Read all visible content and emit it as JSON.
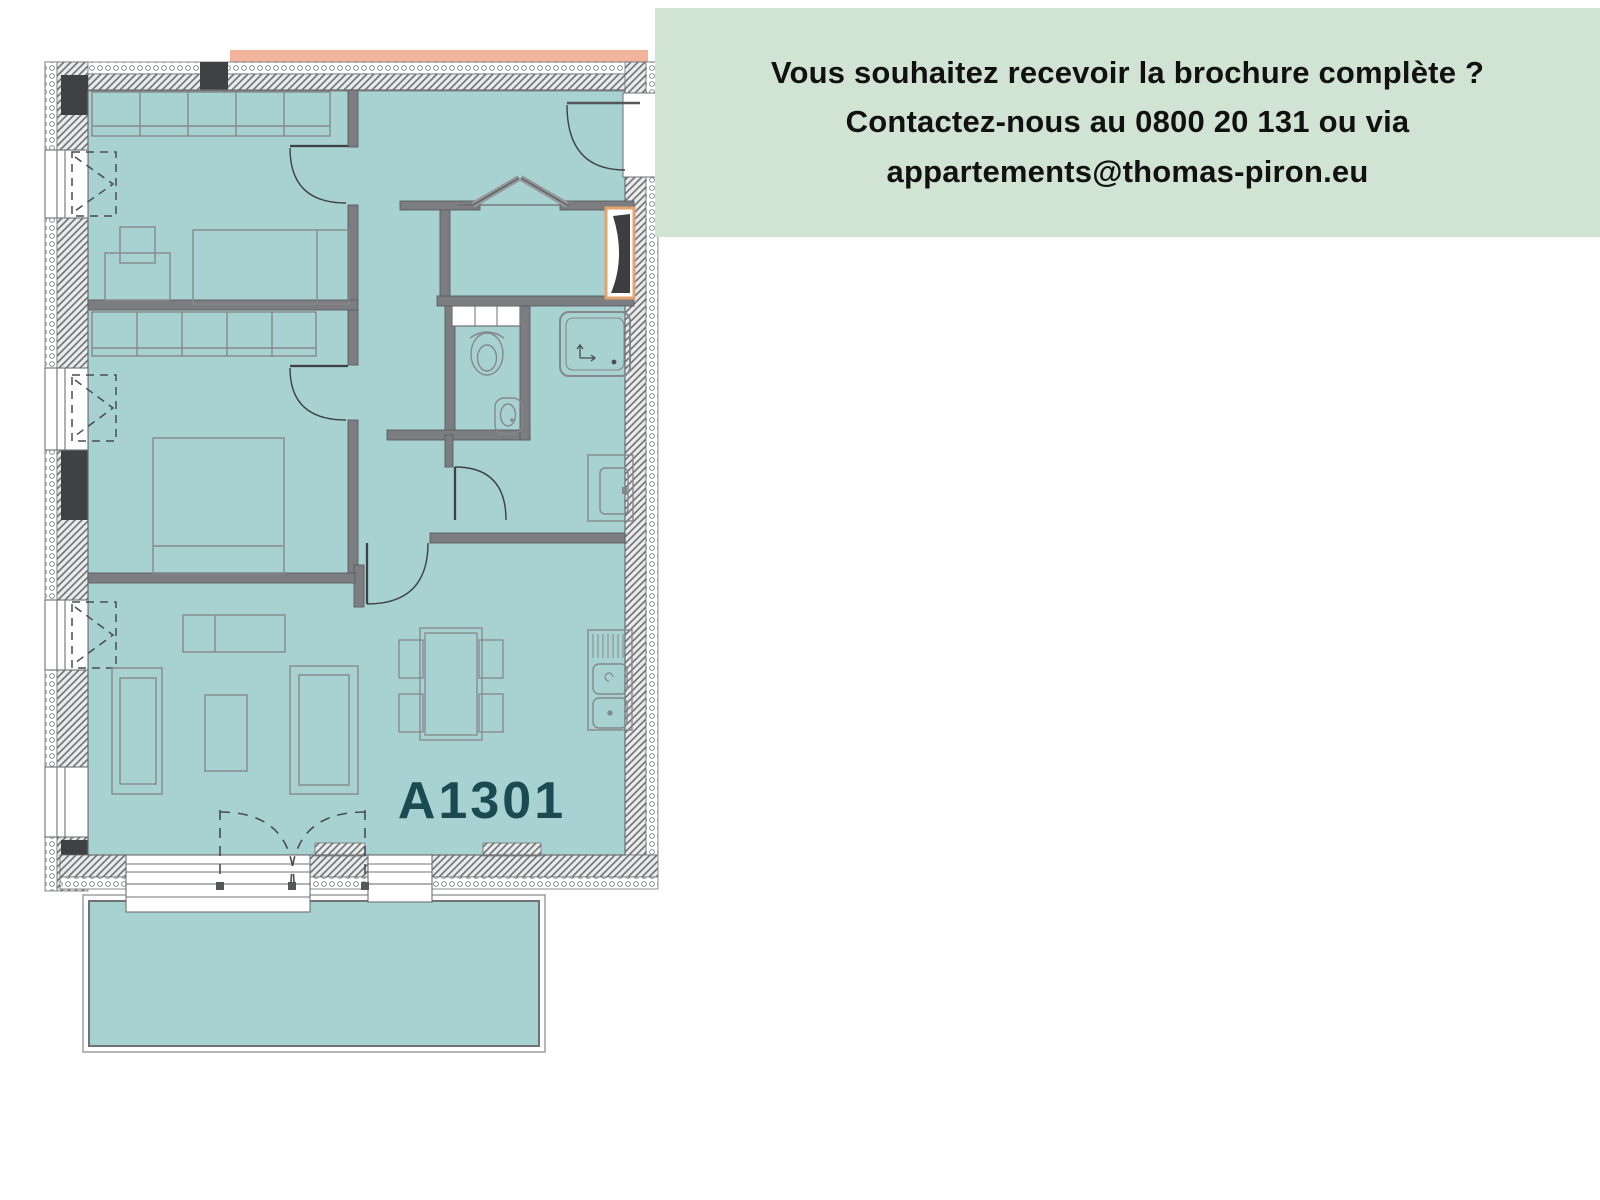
{
  "info_box": {
    "line1": "Vous souhaitez recevoir la brochure complète ?",
    "line2": "Contactez-nous au 0800 20 131 ou via",
    "line3": "appartements@thomas-piron.eu",
    "background_color": "#d1e3d3",
    "text_color": "#111111"
  },
  "floor_plan": {
    "unit_label": "A1301",
    "unit_label_color": "#1a4a52",
    "floor_fill_color": "#a8d1d2",
    "balcony_fill_color": "#a8d1d2",
    "interior_wall_color": "#7b7d80",
    "exterior_top_strip_color": "#f2b49d",
    "shaft_accent_color": "#e2a36e",
    "fixture_icons": [
      "wardrobe",
      "bed",
      "desk",
      "chair",
      "sofa",
      "coffee-table",
      "sideboard",
      "dining-table",
      "kitchen-sink",
      "cooktop",
      "shower",
      "washing-machine",
      "toilet",
      "hand-basin",
      "balcony",
      "window",
      "door-swing"
    ]
  }
}
